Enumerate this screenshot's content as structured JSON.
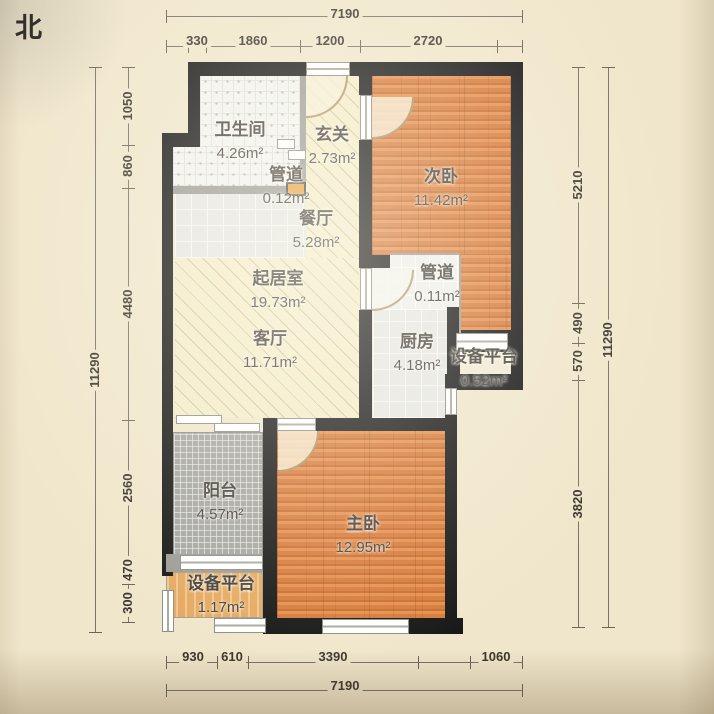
{
  "compass": {
    "north": "北"
  },
  "rooms": {
    "bathroom": {
      "name": "卫生间",
      "area": "4.26m²"
    },
    "entry": {
      "name": "玄关",
      "area": "2.73m²"
    },
    "duct_top": {
      "name": "管道",
      "area": "0.12m²"
    },
    "dining": {
      "name": "餐厅",
      "area": "5.28m²"
    },
    "living_main": {
      "name": "起居室",
      "area": "19.73m²"
    },
    "living": {
      "name": "客厅",
      "area": "11.71m²"
    },
    "bedroom_second": {
      "name": "次卧",
      "area": "11.42m²"
    },
    "duct_mid": {
      "name": "管道",
      "area": "0.11m²"
    },
    "kitchen": {
      "name": "厨房",
      "area": "4.18m²"
    },
    "platform_east": {
      "name": "设备平台",
      "area": "0.52m²"
    },
    "balcony": {
      "name": "阳台",
      "area": "4.57m²"
    },
    "bedroom_master": {
      "name": "主卧",
      "area": "12.95m²"
    },
    "platform_south": {
      "name": "设备平台",
      "area": "1.17m²"
    }
  },
  "dimensions": {
    "top": {
      "total": "7190",
      "segments": [
        "330",
        "1860",
        "1200",
        "2720"
      ]
    },
    "bottom": {
      "total": "7190",
      "segments": [
        "930",
        "610",
        "3390",
        "1060"
      ]
    },
    "left": {
      "total": "11290",
      "segments": [
        "1050",
        "860",
        "4480",
        "2560",
        "470",
        "300"
      ]
    },
    "right": {
      "total": "11290",
      "segments": [
        "5210",
        "490",
        "570",
        "3820"
      ]
    }
  },
  "colors": {
    "wall": "#161616",
    "wood_floor": "#d87c3c",
    "tile_floor": "#e6e6e3",
    "hatch_floor": "#f4ecca",
    "balcony_tile": "#a5a5a1",
    "platform_fill": "#e5a95f",
    "paper": "#f0e6cb"
  }
}
